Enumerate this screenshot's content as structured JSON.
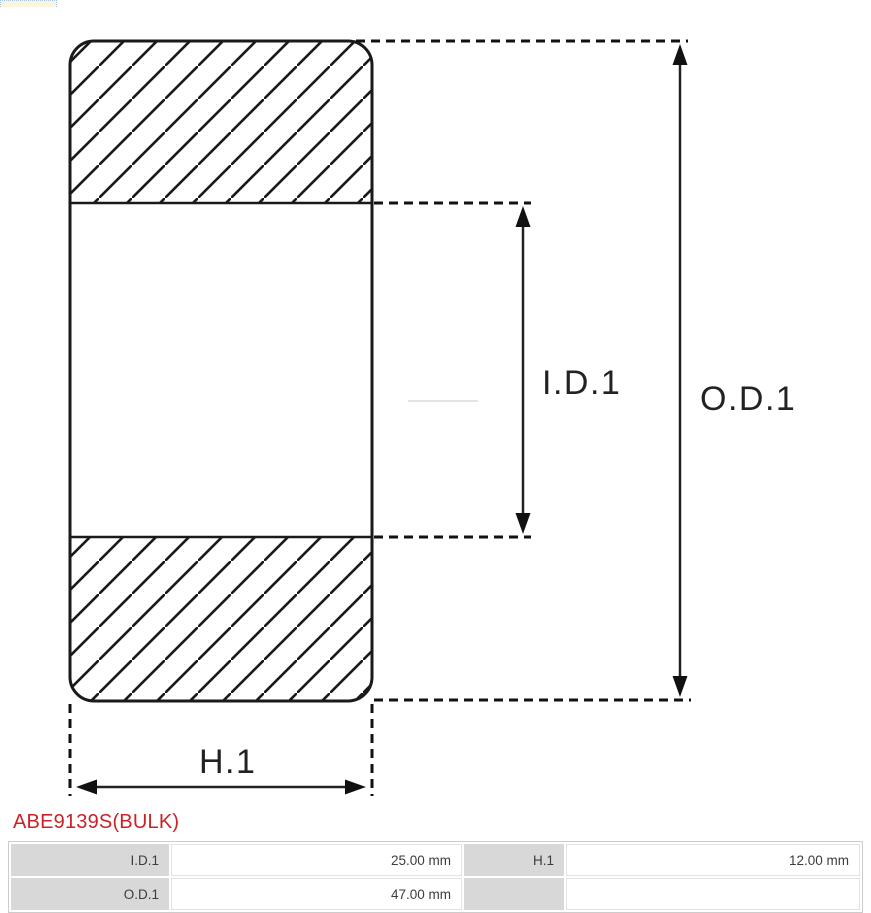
{
  "theme": {
    "line_color": "#1a1a1a",
    "accent_red": "#cc2127",
    "table_label_bg": "#d8d8d8",
    "table_border": "#cccccc"
  },
  "diagram": {
    "type": "bearing-cross-section-drawing",
    "labels": {
      "id1": "I.D.1",
      "od1": "O.D.1",
      "h1": "H.1"
    }
  },
  "product": {
    "code": "ABE9139S(BULK)",
    "code_color": "#cc2127"
  },
  "spec_table": {
    "rows": [
      [
        "I.D.1",
        "25.00 mm",
        "H.1",
        "12.00 mm"
      ],
      [
        "O.D.1",
        "47.00 mm",
        "",
        ""
      ]
    ]
  }
}
